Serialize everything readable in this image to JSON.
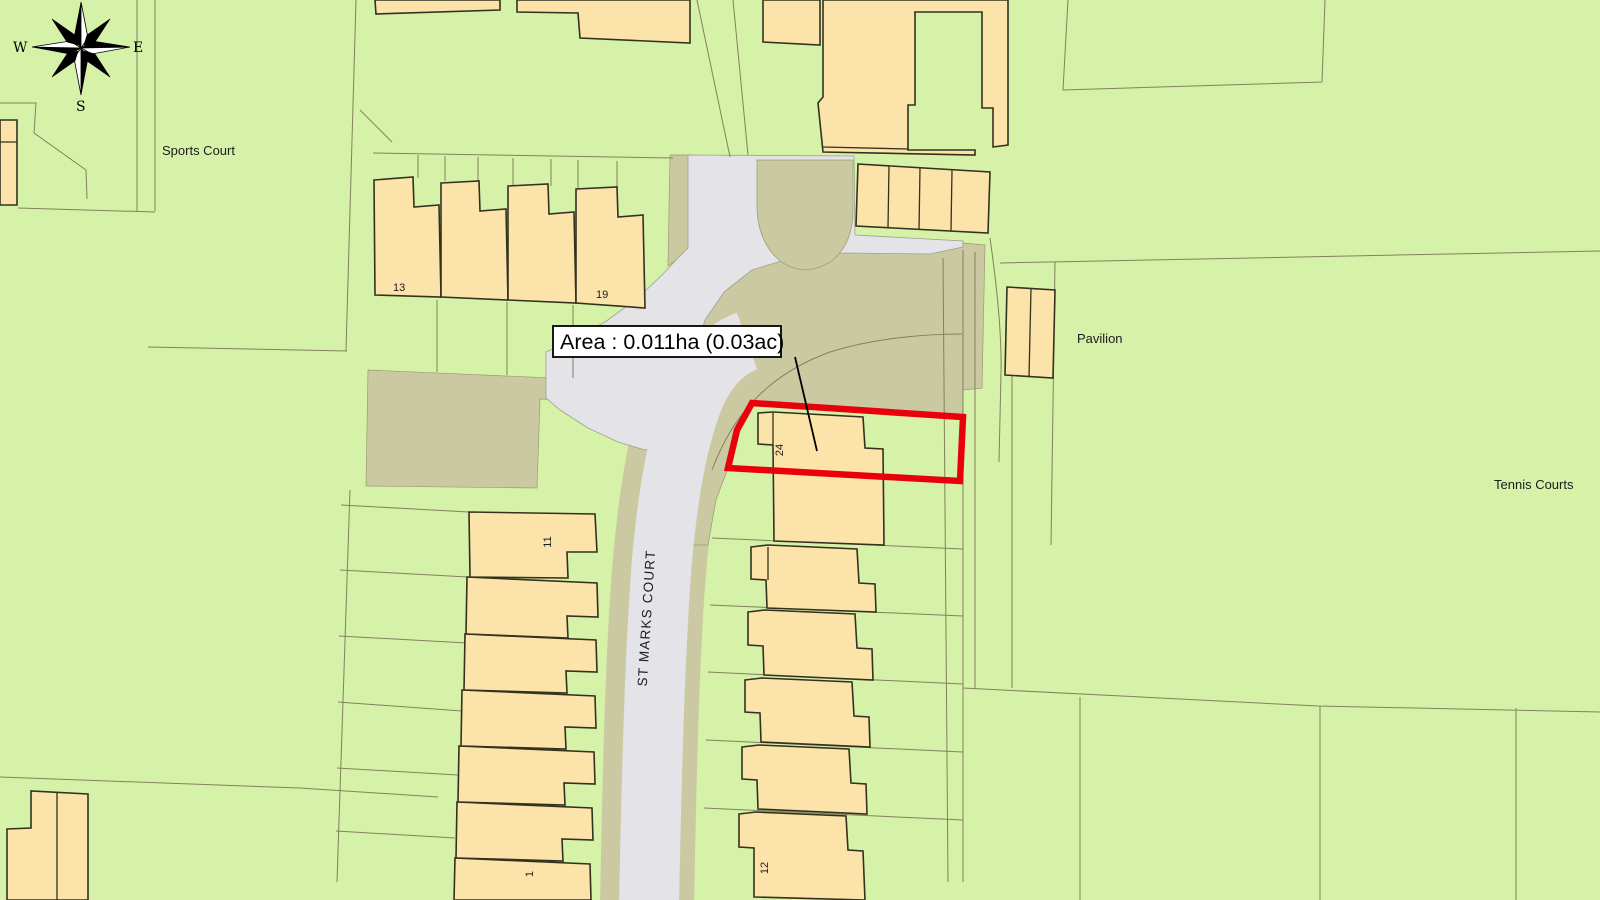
{
  "map": {
    "area_label": "Area : 0.011ha (0.03ac)",
    "street_label": "ST MARKS COURT",
    "labels": {
      "sports_court": "Sports Court",
      "pavilion": "Pavilion",
      "tennis_courts": "Tennis Courts"
    },
    "house_numbers": {
      "n13": "13",
      "n19": "19",
      "n24": "24",
      "n11": "11",
      "n12": "12",
      "n1": "1"
    },
    "compass": {
      "west": "W",
      "east": "E",
      "south": "S"
    },
    "colors": {
      "background_green": "#d6f1a8",
      "building_fill": "#fbe3aa",
      "building_outline": "#32321e",
      "road_gray": "#e4e3e8",
      "verge_khaki": "#cbc9a1",
      "parcel_line": "#82825c",
      "plot_outline_red": "#e8000b",
      "label_bg": "#ffffff",
      "label_text": "#000000"
    }
  }
}
